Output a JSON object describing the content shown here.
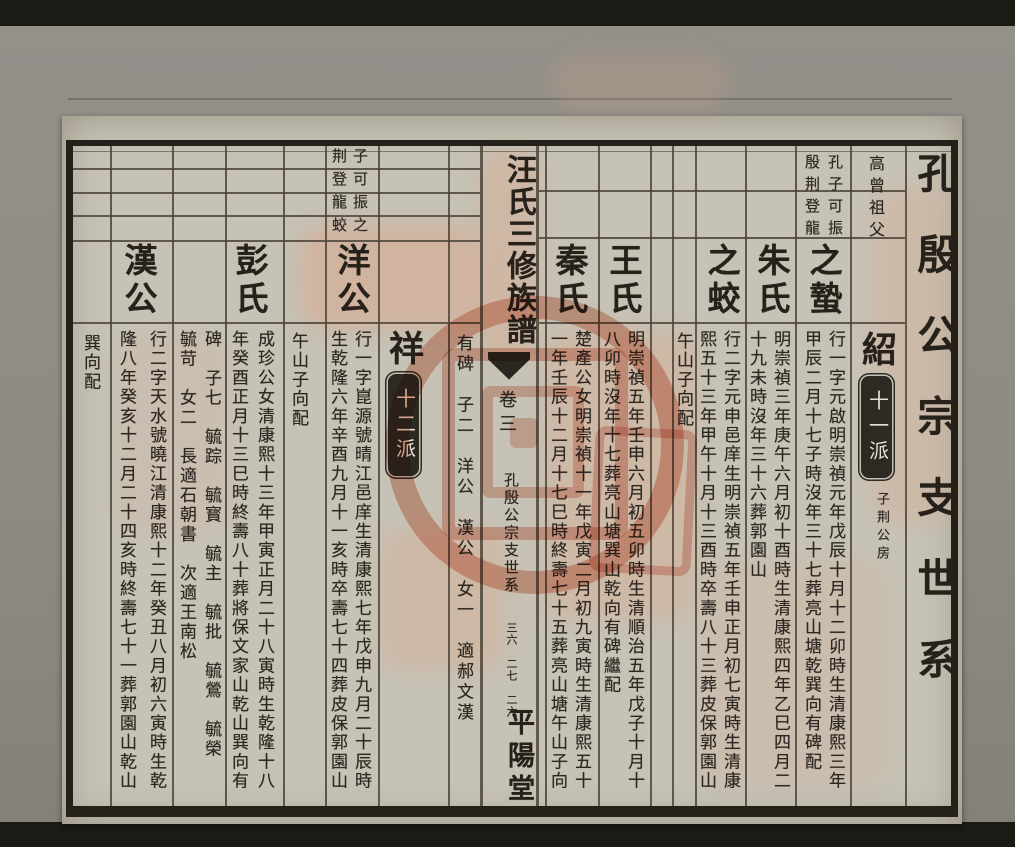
{
  "colors": {
    "paper": "#c6c2b5",
    "ink": "#2d2822",
    "seal_red": "#cd502e",
    "cartouche_bg": "#2d2a24",
    "mat_gray": "#8f8d85"
  },
  "document": {
    "margin_title": "孔殷公宗支世系",
    "strip": {
      "book_title": "汪氏三修族譜",
      "volume": "卷三",
      "section": "孔殷公宗支世系",
      "page_marks": "三六　二七　二六",
      "hall": "平陽堂"
    },
    "right_half": {
      "ancestor_table": {
        "labels": "高曾祖父",
        "names_a": "孔子可振",
        "names_b": "殷荆登龍"
      },
      "generation_marker": {
        "char": "紹",
        "badge": "十一派",
        "branch": "子荆公房"
      },
      "sections": [
        {
          "name": "之蟄",
          "bio_r": "行一字元啟明崇禎元年戊辰十月十二卯時生清康熙三年",
          "bio_l": "甲辰二月十七子時沒年三十七葬亮山塘乾巽向有碑配"
        },
        {
          "name": "朱氏",
          "bio_r": "明崇禎三年庚午六月初十酉時生清康熙四年乙巳四月二",
          "bio_l": "十九未時沒年三十六葬郭園山"
        },
        {
          "name": "之蛟",
          "bio_r": "行二字元申邑庠生明崇禎五年壬申正月初七寅時生清康",
          "bio_l": "熙五十三年甲午十月十三酉時卒壽八十三葬皮保郭園山"
        },
        {
          "name": "王氏",
          "bio_r": "明崇禎五年壬申六月初五卯時生清順治五年戊子十月十",
          "bio_l": "八卯時沒年十七葬亮山塘巽山乾向有碑繼配"
        },
        {
          "name": "秦氏",
          "bio_r": "楚產公女明崇禎十一年戊寅二月初九寅時生清康熙五十",
          "bio_l": "一年壬辰十二月十七巳時終壽七十五葬亮山塘午山子向"
        }
      ],
      "burial_note": "午山子向配"
    },
    "left_half": {
      "ancestor_table": {
        "names_a": "子可振之",
        "names_b": "荆登龍蛟"
      },
      "generation_marker": {
        "char": "祥",
        "badge": "十二派"
      },
      "children_of_previous": "有碑　子二　洋公　漢公　女一　適郝文漢",
      "sections": [
        {
          "name": "洋公",
          "bio_r": "行一字崑源號晴江邑庠生清康熙七年戊申九月二十辰時",
          "bio_l": "生乾隆六年辛酉九月十一亥時卒壽七十四葬皮保郭園山"
        },
        {
          "name": "彭氏",
          "bio_r": "成珍公女清康熙十三年甲寅正月二十八寅時生乾隆十八",
          "bio_l": "年癸酉正月十三巳時終壽八十葬將保文家山乾山巽向有"
        },
        {
          "name": "漢公",
          "bio_r": "行二字天水號曉江清康熙十二年癸丑八月初六寅時生乾",
          "bio_l": "隆八年癸亥十二月二十四亥時終壽七十一葬郭園山乾山"
        }
      ],
      "children_cols": {
        "right": "碑　子七　毓踪　毓寳　毓主　毓批　毓鶯　毓榮",
        "left": "毓苛　女二　長適石朝書　次適王南松"
      },
      "burial_note": "午山子向配",
      "burial_note_far_left": "巽向配"
    }
  }
}
